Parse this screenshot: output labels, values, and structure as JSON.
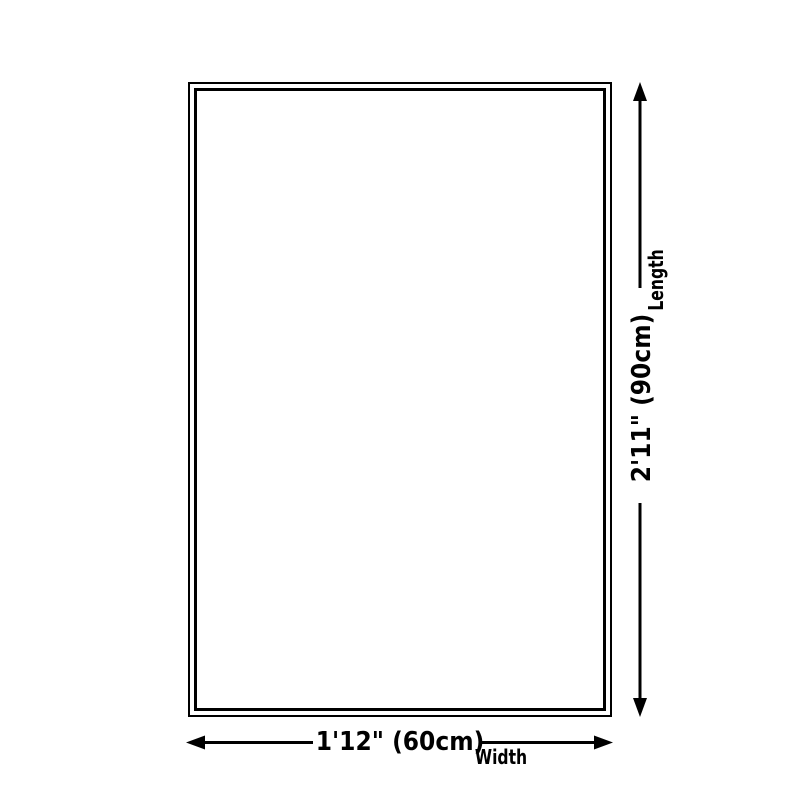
{
  "page": {
    "background_color": "#ffffff",
    "line_color": "#000000"
  },
  "diagram": {
    "type": "product-dimension-diagram",
    "dimensions": {
      "length": {
        "value": "2'11\" (90cm)",
        "label": "Length"
      },
      "width": {
        "value": "1'12\" (60cm)",
        "label": "Width"
      }
    }
  }
}
